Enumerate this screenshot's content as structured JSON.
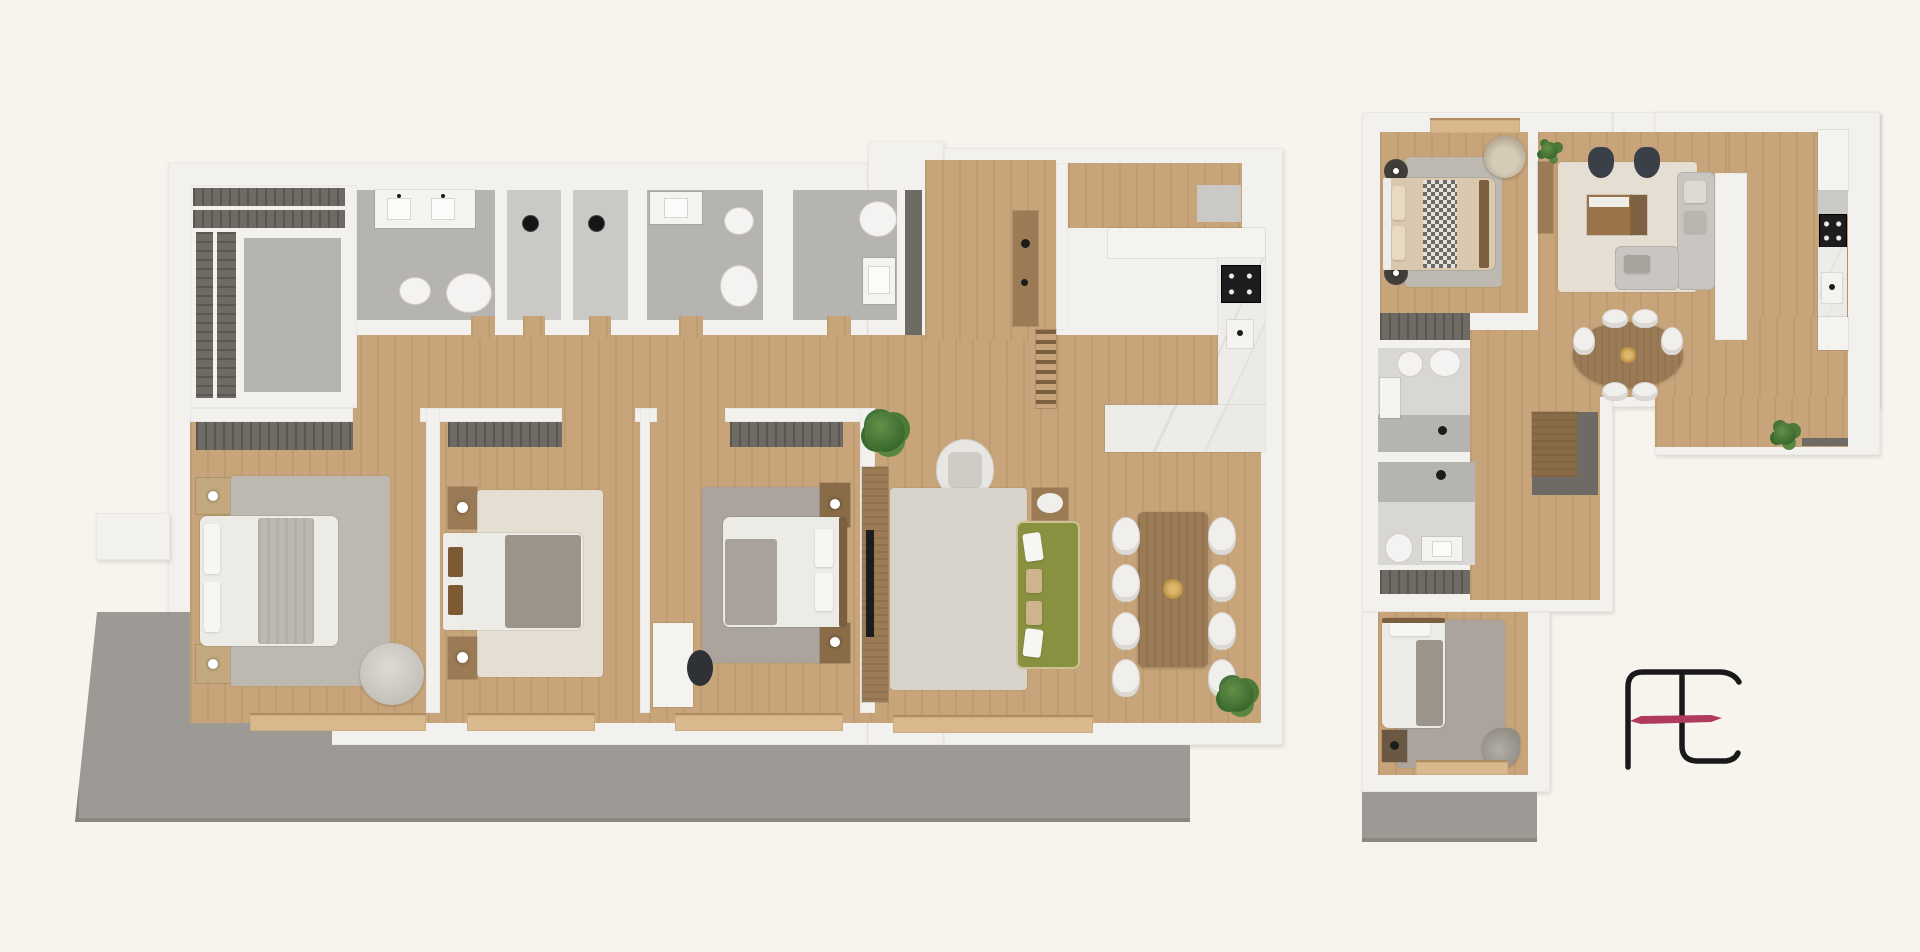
{
  "document": {
    "kind": "real-estate floor plan sheet",
    "visible_text": ""
  },
  "palette": {
    "background": "#f7f4ee",
    "wall": "#f3f1ee",
    "wall_edge": "#d9d6d1",
    "wood": "#c7a47a",
    "wood_light": "#d8b88c",
    "wood_dark": "#9b7b55",
    "wood_deep": "#7b5f3e",
    "tile": "#b6b4b1",
    "tile_light": "#cbc9c6",
    "tile_pale": "#d9d7d4",
    "wardrobe": "#6e6a64",
    "wardrobe_line": "#5a5752",
    "terrace": "#9d9a96",
    "terrace_dark": "#8a8781",
    "rug_light": "#d8d4cc",
    "rug_cream": "#e5dfd3",
    "rug_gray": "#aaa49c",
    "rug_warmgray": "#bdb8b0",
    "white_obj": "#f4f3f0",
    "sofa_olive": "#87913f",
    "charcoal": "#3a4048",
    "black": "#1c1c1c",
    "plant": "#4a7a35",
    "marble": "#e9e8e4",
    "gold": "#c9a14e",
    "logo_ink": "#191919",
    "logo_accent": "#b03a5e"
  },
  "plans": [
    {
      "name": "large-apartment-plan",
      "rooms": [
        "walk-in-closet",
        "bathroom-double-vanity",
        "shower-room",
        "shower-room",
        "bathroom",
        "bathroom-small",
        "hallway",
        "entry",
        "kitchen",
        "bedroom-master",
        "bedroom-2",
        "bedroom-3",
        "living-room",
        "dining-area",
        "terrace"
      ],
      "furniture": [
        "wardrobe-shelving",
        "double-sink-vanity",
        "toilet",
        "bidet",
        "pendant-light",
        "bed",
        "nightstand",
        "rug",
        "pouf",
        "desk",
        "desk-chair",
        "tv-console",
        "tv",
        "armchair",
        "side-table",
        "olive-sofa",
        "dining-table",
        "dining-chair",
        "kitchen-island",
        "cooktop",
        "sink",
        "stairs",
        "console-table",
        "plant",
        "balcony-sill"
      ]
    },
    {
      "name": "small-apartment-plan",
      "rooms": [
        "bedroom",
        "living-room",
        "kitchen",
        "dining-area",
        "hallway",
        "bathroom",
        "bathroom-2",
        "wardrobe-nook",
        "bedroom-2",
        "terrace"
      ],
      "furniture": [
        "bed",
        "rug",
        "wall-lamp",
        "round-armchair",
        "checker-throw",
        "armchair-pair",
        "media-cabinet",
        "corner-sofa",
        "partition-wall",
        "sideboard",
        "oval-dining-table",
        "dining-chair",
        "gold-centerpiece",
        "cooktop",
        "sink",
        "counter",
        "toilet",
        "bidet",
        "sink-cabinet",
        "shower-drain",
        "shower-head",
        "wardrobe-slats",
        "corner-closet",
        "nightstand",
        "balcony-sill",
        "plant",
        "shelf-strip"
      ]
    }
  ],
  "logo": {
    "name": "ft-monogram",
    "ink": "#191919",
    "accent": "#b03a5e"
  }
}
